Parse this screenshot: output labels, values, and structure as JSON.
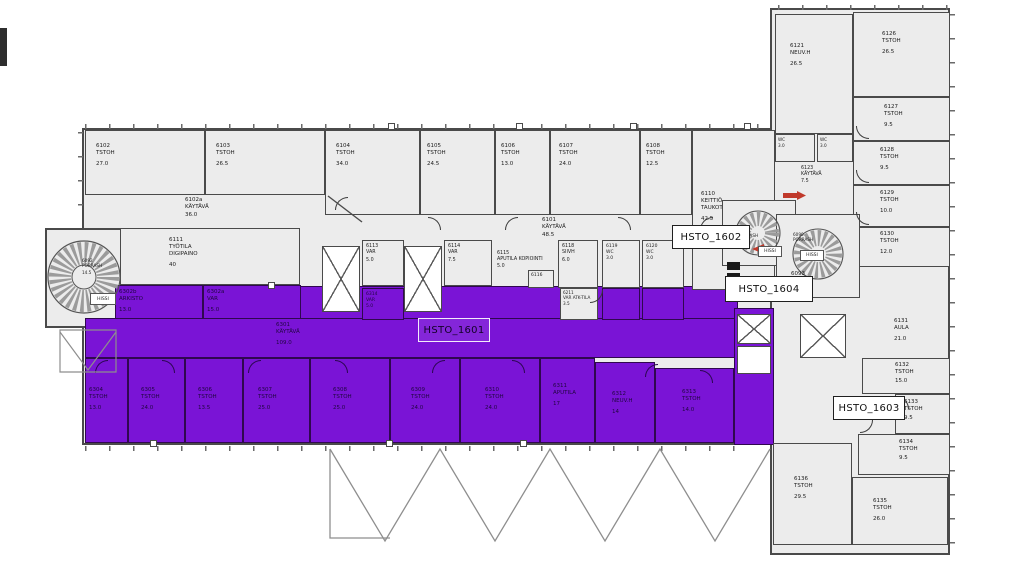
{
  "units": {
    "u1601": "HSTO_1601",
    "u1602": "HSTO_1602",
    "u1603": "HSTO_1603",
    "u1604": "HSTO_1604"
  },
  "colors": {
    "highlight_purple": "#7a14d6",
    "wall_gray": "#4a4a4a",
    "room_fill": "#ececec",
    "marker_red": "#c0392b"
  },
  "rooms": {
    "r6102": {
      "code": "6102",
      "name": "TSTOH",
      "area": "27.0"
    },
    "r6103": {
      "code": "6103",
      "name": "TSTOH",
      "area": "26.5"
    },
    "r6104": {
      "code": "6104",
      "name": "TSTOH",
      "area": "34.0"
    },
    "r6105": {
      "code": "6105",
      "name": "TSTOH",
      "area": "24.5"
    },
    "r6106": {
      "code": "6106",
      "name": "TSTOH",
      "area": "13.0"
    },
    "r6107": {
      "code": "6107",
      "name": "TSTOH",
      "area": "24.0"
    },
    "r6108": {
      "code": "6108",
      "name": "TSTOH",
      "area": "12.5"
    },
    "r6110": {
      "code": "6110",
      "name": "KEITTIÖ TAUKOTILA",
      "area": "42.5"
    },
    "r6102a": {
      "code": "6102a",
      "name": "KÄYTÄVÄ",
      "area": "36.0"
    },
    "r6101": {
      "code": "6101",
      "name": "KÄYTÄVÄ",
      "area": "48.5"
    },
    "r6111": {
      "code": "6111",
      "name": "TYÖTILA DIGIPAINO",
      "area": "40"
    },
    "r6113": {
      "code": "6113",
      "name": "VAR",
      "area": "5.0"
    },
    "r6114": {
      "code": "6114",
      "name": "VAR",
      "area": "7.5"
    },
    "r6115": {
      "code": "6115",
      "name": "APUTILA KOPIOINTI",
      "area": "5.0"
    },
    "r6116": {
      "code": "6116"
    },
    "r6118": {
      "code": "6118",
      "name": "SIIVH",
      "area": "6.0"
    },
    "r6119": {
      "code": "6119",
      "name": "WC",
      "area": "3.0"
    },
    "r6120": {
      "code": "6120",
      "name": "WC",
      "area": "3.0"
    },
    "r6211": {
      "code": "6211",
      "name": "VAR ATK-TILA",
      "area": "3.5"
    },
    "r6121": {
      "code": "6121",
      "name": "NEUV.H",
      "area": "26.5"
    },
    "r6126": {
      "code": "6126",
      "name": "TSTOH",
      "area": "26.5"
    },
    "r6127": {
      "code": "6127",
      "name": "TSTOH",
      "area": "9.5"
    },
    "r6128": {
      "code": "6128",
      "name": "TSTOH",
      "area": "9.5"
    },
    "r6129": {
      "code": "6129",
      "name": "TSTOH",
      "area": "10.0"
    },
    "r6130": {
      "code": "6130",
      "name": "TSTOH",
      "area": "12.0"
    },
    "rwc1": {
      "name": "WC",
      "area": "3.0"
    },
    "rwc2": {
      "name": "WC",
      "area": "3.0"
    },
    "r6123": {
      "code": "6123",
      "name": "KÄYTÄVÄ",
      "area": "7.5"
    },
    "r6093": {
      "code": "6093",
      "name": "AULA",
      "area": "20.5"
    },
    "r6131": {
      "code": "6131",
      "name": "AULA",
      "area": "21.0"
    },
    "r6132": {
      "code": "6132",
      "name": "TSTOH",
      "area": "15.0"
    },
    "r6133": {
      "code": "6133",
      "name": "TSTOH",
      "area": "9.5"
    },
    "r6134": {
      "code": "6134",
      "name": "TSTOH",
      "area": "9.5"
    },
    "r6135": {
      "code": "6135",
      "name": "TSTOH",
      "area": "26.0"
    },
    "r6136": {
      "code": "6136",
      "name": "TSTOH",
      "area": "29.5"
    },
    "p6302b": {
      "code": "6302b",
      "name": "ARKISTO",
      "area": "13.0"
    },
    "p6302a": {
      "code": "6302a",
      "name": "VAR",
      "area": "15.0"
    },
    "p6301": {
      "code": "6301",
      "name": "KÄYTÄVÄ",
      "area": "109.0"
    },
    "p6304": {
      "code": "6304",
      "name": "TSTOH",
      "area": "13.0"
    },
    "p6305": {
      "code": "6305",
      "name": "TSTOH",
      "area": "24.0"
    },
    "p6306": {
      "code": "6306",
      "name": "TSTOH",
      "area": "13.5"
    },
    "p6307": {
      "code": "6307",
      "name": "TSTOH",
      "area": "25.0"
    },
    "p6308": {
      "code": "6308",
      "name": "TSTOH",
      "area": "25.0"
    },
    "p6309": {
      "code": "6309",
      "name": "TSTOH",
      "area": "24.0"
    },
    "p6310": {
      "code": "6310",
      "name": "TSTOH",
      "area": "24.0"
    },
    "p6311": {
      "code": "6311",
      "name": "APUTILA",
      "area": "17"
    },
    "p6312": {
      "code": "6312",
      "name": "NEUV.H",
      "area": "14"
    },
    "p6313": {
      "code": "6313",
      "name": "TSTOH",
      "area": "14.0"
    },
    "p6314": {
      "code": "6314",
      "name": "VAR",
      "area": "5.0"
    }
  },
  "stairs": {
    "s6092": {
      "code": "6092",
      "name": "PORRASH",
      "area": "14.5",
      "lift": "HISSI"
    },
    "s6091": {
      "code": "6091",
      "name": "PORRASH",
      "lift": "HISSI"
    },
    "s6090": {
      "code": "6090",
      "name": "PORRASH",
      "lift": "HISSI"
    }
  }
}
